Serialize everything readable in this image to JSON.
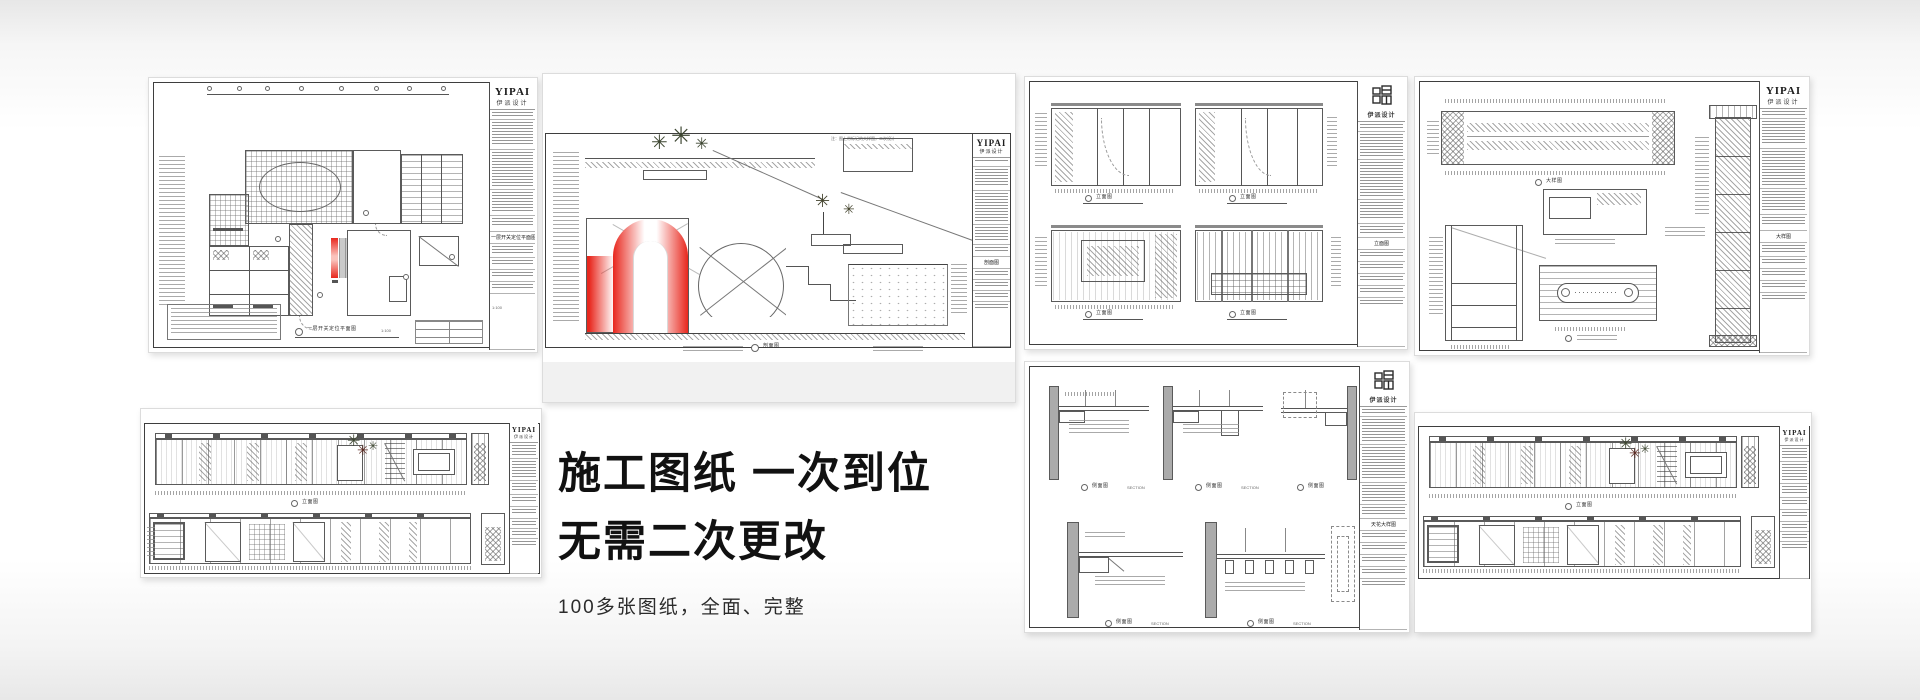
{
  "brand": {
    "name_en": "YIPAI",
    "name_cn": "伊派设计",
    "accent_red": "#e8271d",
    "paper_white": "#ffffff",
    "line_gray": "#5a5a5a"
  },
  "hero": {
    "title_line1": "施工图纸 一次到位",
    "title_line2": "无需二次更改",
    "subtitle": "100多张图纸，全面、完整",
    "text_color": "#111111"
  },
  "sheets": {
    "floor_plan": {
      "title": "一层开关定位平面图",
      "scale": "1:100"
    },
    "arch_section": {
      "title": "剖面图",
      "note": "注：图上带标记的大样图，二次设计"
    },
    "wall_elevations": {
      "labels": [
        "立面图",
        "立面图",
        "立面图",
        "立面图"
      ]
    },
    "joinery_details": {
      "title": "大样图"
    },
    "long_elevation_a": {
      "title": "立面图"
    },
    "ceiling_details": {
      "labels": [
        "侧面图",
        "侧面图",
        "侧面图",
        "侧面图",
        "侧面图"
      ],
      "label_en": "SECTION",
      "title": "天花大样图"
    },
    "long_elevation_b": {
      "title": "立面图"
    }
  }
}
